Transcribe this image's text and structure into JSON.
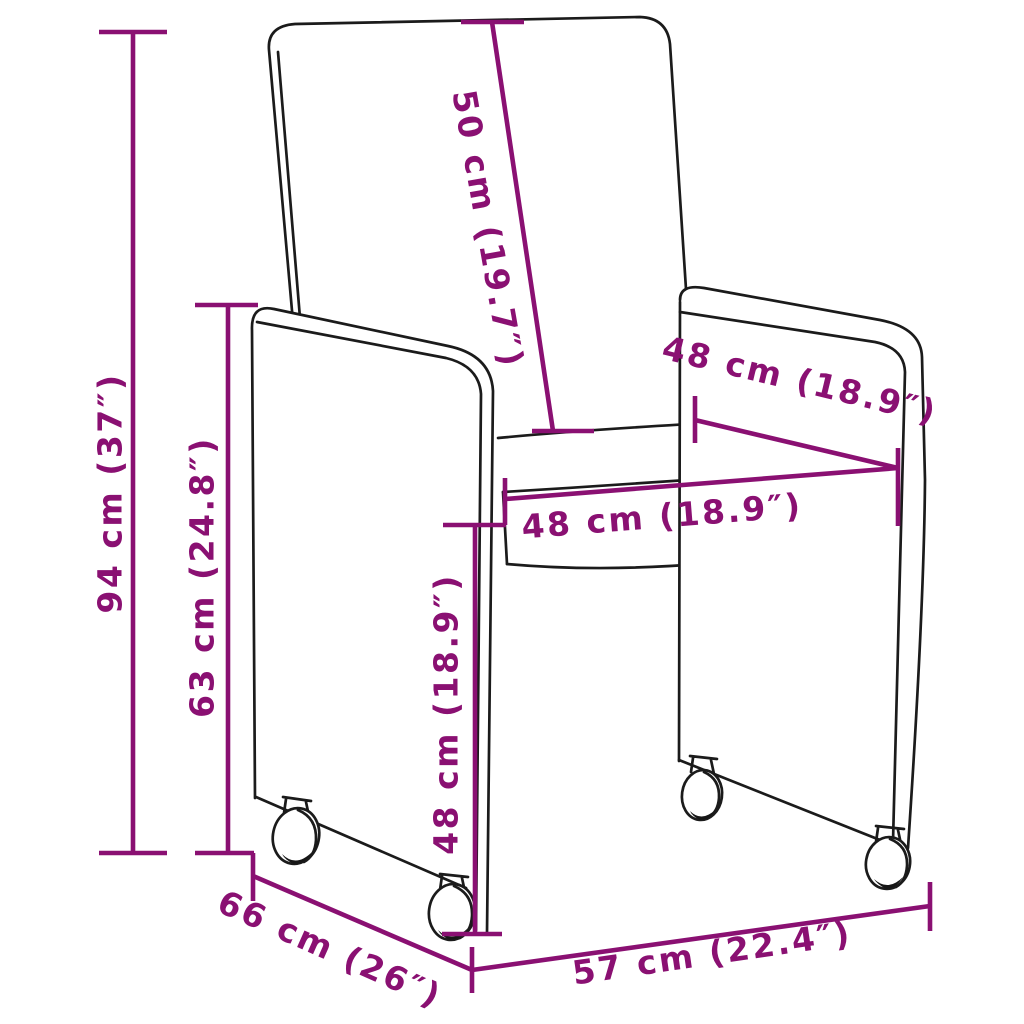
{
  "diagram": {
    "type": "product-dimension-diagram",
    "subject": "upholstered dining chair with caster wheels, three-quarter line drawing",
    "accent_color": "#8A1072",
    "line_color": "#1b1b1b",
    "background_color": "#ffffff",
    "labels": {
      "overall_height": "94 cm (37″)",
      "armrest_height": "63 cm (24.8″)",
      "backrest_length": "50 cm (19.7″)",
      "seat_depth": "48 cm (18.9″)",
      "seat_width": "48 cm (18.9″)",
      "seat_height": "48 cm (18.9″)",
      "overall_depth": "66 cm (26″)",
      "overall_width": "57 cm (22.4″)"
    }
  }
}
